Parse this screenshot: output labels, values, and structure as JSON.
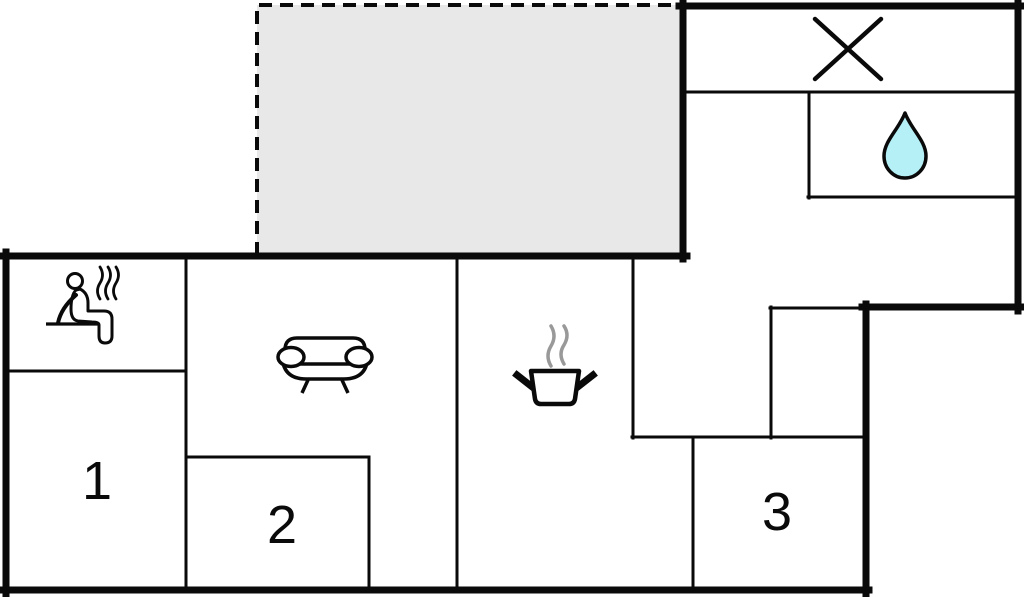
{
  "plan": {
    "kind": "vacation-home floor plan",
    "rooms": {
      "bedroom1": {
        "label": "1"
      },
      "bedroom2": {
        "label": "2"
      },
      "bedroom3": {
        "label": "3"
      }
    },
    "icons": {
      "sauna": "sauna-icon",
      "sofa": "sofa-icon",
      "cooking_pot": "cooking-pot-icon",
      "water_drop": "water-drop-icon",
      "cross": "cross-icon"
    },
    "colors": {
      "wall": "#0a0a0a",
      "background": "#ffffff",
      "terrace_fill": "#e8e8e8",
      "water_drop_fill": "#b5f0f6",
      "steam_gray": "#999999",
      "icon_fill": "#ffffff"
    }
  }
}
